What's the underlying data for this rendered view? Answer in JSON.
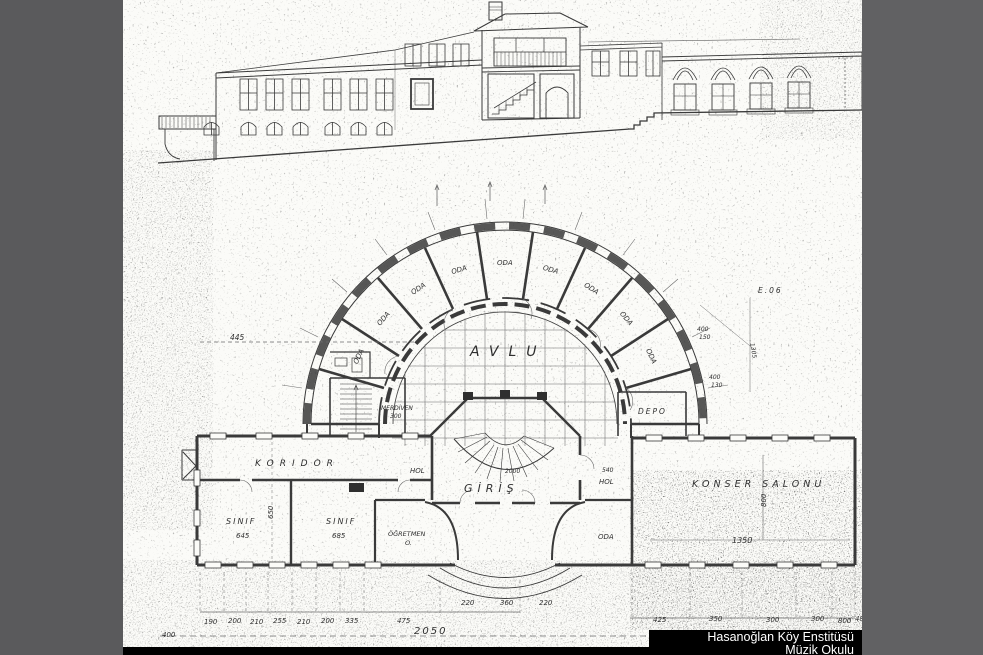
{
  "colors": {
    "side_bars": "#5a5a5c",
    "caption_bg": "#000000",
    "caption_fg": "#ffffff",
    "ink": "#3a3a3a",
    "paper": "#fbfbf8"
  },
  "caption": {
    "line1": "Hasanoğlan Köy Enstitüsü",
    "line2": "Müzik Okulu"
  },
  "plan": {
    "courtyard": "AVLU",
    "radial_rooms": [
      "ODA",
      "ODA",
      "ODA",
      "ODA",
      "ODA",
      "ODA",
      "ODA",
      "ODA",
      "ODA"
    ],
    "corridor": "KORIDOR",
    "corridor_dim": "650",
    "classroom_left": "SINIF",
    "classroom_left_dim": "645",
    "classroom_right": "SINIF",
    "classroom_right_dim": "685",
    "teachers_room_line1": "ÖĞRETMEN",
    "teachers_room_line2": "O.",
    "entrance": "GİRİŞ",
    "hall_left": "HOL",
    "hall_right": "HOL",
    "room_right": "ODA",
    "storage": "DEPO",
    "stairs": "MERDİVEN",
    "stairs_dim": "300",
    "concert_hall": "KONSER SALONU",
    "concert_hall_width": "1350",
    "concert_hall_depth": "800",
    "note_top_right": "E.06",
    "dim_left": "445",
    "dim_540": "540",
    "dim_2000": "2000",
    "dims_bottom": [
      "190",
      "200",
      "210",
      "255",
      "210",
      "200",
      "335",
      "475"
    ],
    "dims_bottom_right": [
      "425",
      "350",
      "300",
      "300",
      "800",
      "485"
    ],
    "dims_mid": [
      "220",
      "360",
      "220"
    ],
    "dims_diag": [
      "400",
      "150",
      "400",
      "130",
      "1305"
    ],
    "dim_total": "2050",
    "dim_first": "400"
  }
}
